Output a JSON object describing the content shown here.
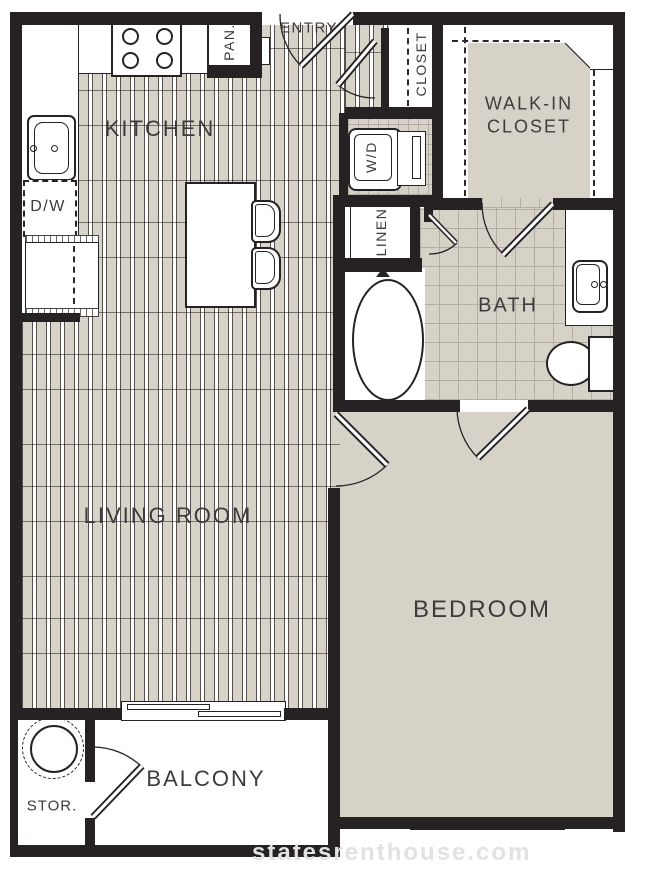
{
  "plan": {
    "title": "One-bedroom apartment floor plan",
    "rooms": {
      "kitchen": "KITCHEN",
      "entry": "ENTRY",
      "pantry": "PAN.",
      "closet": "CLOSET",
      "walkin_line1": "WALK-IN",
      "walkin_line2": "CLOSET",
      "washer_dryer": "W/D",
      "linen": "LINEN",
      "bath": "BATH",
      "living": "LIVING ROOM",
      "bedroom": "BEDROOM",
      "balcony": "BALCONY",
      "storage": "STOR.",
      "dishwasher": "D/W"
    },
    "watermark": "statesrenthouse.com",
    "colors": {
      "wall": "#262223",
      "wood_plank": "#d8d3c9",
      "carpet": "#d7d2c8",
      "tile_grout": "#b3aea4",
      "label_text": "#3d3b3c",
      "watermark_text": "#e2e2e2"
    }
  }
}
